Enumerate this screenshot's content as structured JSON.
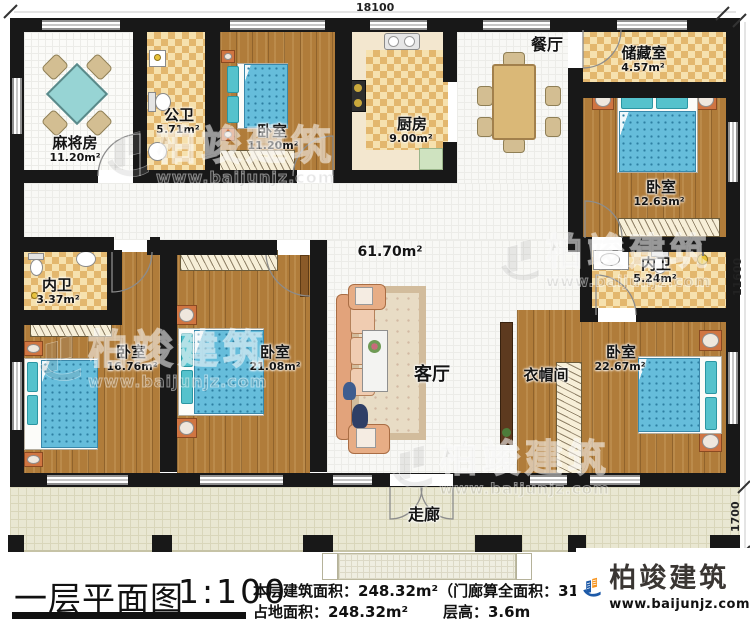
{
  "plan": {
    "title": "一层平面图",
    "scale": "1:100",
    "stats_line1": "本层建筑面积：248.32m²（门廊算全面积：31.1",
    "stats_land": "占地面积：248.32m²",
    "stats_height": "层高：3.6m",
    "dim_top": "18100",
    "dim_right": "11600",
    "dim_porch": "1700",
    "living_area": "61.70m²"
  },
  "rooms": {
    "mahjong": {
      "name": "麻将房",
      "area": "11.20m²"
    },
    "public_bath": {
      "name": "公卫",
      "area": "5.71m²"
    },
    "bedroom_n": {
      "name": "卧室",
      "area": "11.20m²"
    },
    "kitchen": {
      "name": "厨房",
      "area": "9.00m²"
    },
    "dining": {
      "name": "餐厅"
    },
    "storage": {
      "name": "储藏室",
      "area": "4.57m²"
    },
    "bedroom_ne": {
      "name": "卧室",
      "area": "12.63m²"
    },
    "bath_e": {
      "name": "内卫",
      "area": "5.24m²"
    },
    "bedroom_se": {
      "name": "卧室",
      "area": "22.67m²"
    },
    "cloakroom": {
      "name": "衣帽间"
    },
    "bath_w": {
      "name": "内卫",
      "area": "3.37m²"
    },
    "bedroom_sw": {
      "name": "卧室",
      "area": "16.76m²"
    },
    "bedroom_s": {
      "name": "卧室",
      "area": "21.08m²"
    },
    "living": {
      "name": "客厅"
    },
    "corridor": {
      "name": "走廊"
    }
  },
  "branding": {
    "name": "柏竣建筑",
    "url": "www.baijunjz.com",
    "colors": {
      "blue": "#1d5aa8",
      "orange": "#f7941d"
    }
  }
}
